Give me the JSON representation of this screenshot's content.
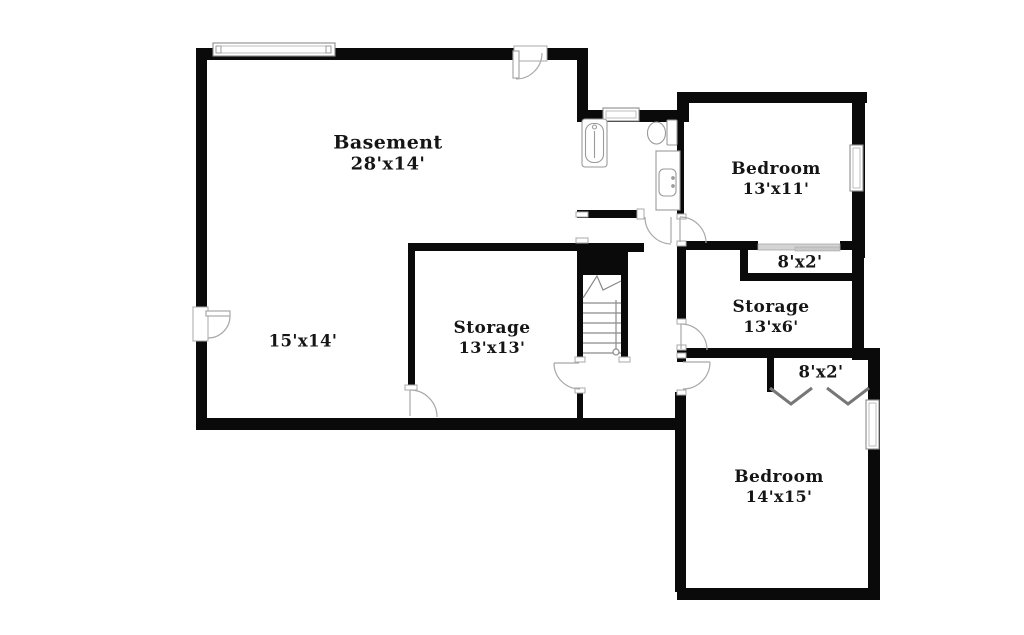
{
  "plan": {
    "title": "Basement floor plan",
    "colors": {
      "background": "#ffffff",
      "wall": "#0a0a0a",
      "door_arc": "#a8a8a8",
      "fixture": "#9a9a9a",
      "sliding_door": "#d4d4d4",
      "label_text": "#151515"
    },
    "rooms": [
      {
        "id": "basement",
        "name": "Basement",
        "dimensions": "28'x14'"
      },
      {
        "id": "area-15x14",
        "name": "",
        "dimensions": "15'x14'"
      },
      {
        "id": "storage-13x13",
        "name": "Storage",
        "dimensions": "13'x13'"
      },
      {
        "id": "bedroom-13x11",
        "name": "Bedroom",
        "dimensions": "13'x11'"
      },
      {
        "id": "closet-8x2-top",
        "name": "",
        "dimensions": "8'x2'"
      },
      {
        "id": "storage-13x6",
        "name": "Storage",
        "dimensions": "13'x6'"
      },
      {
        "id": "closet-8x2-bottom",
        "name": "",
        "dimensions": "8'x2'"
      },
      {
        "id": "bedroom-14x15",
        "name": "Bedroom",
        "dimensions": "14'x15'"
      }
    ]
  }
}
